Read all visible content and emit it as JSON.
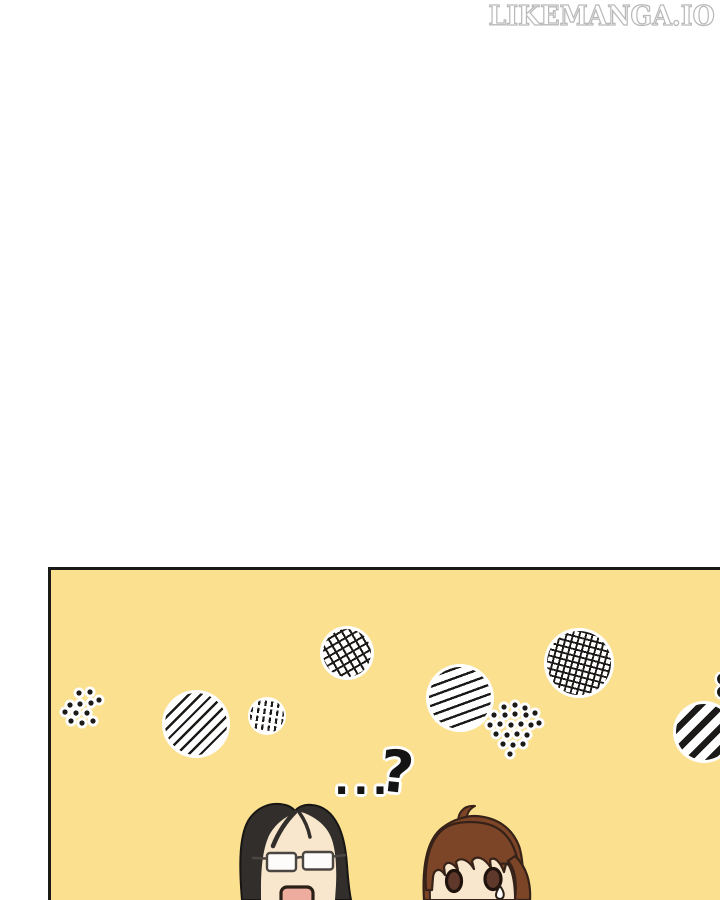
{
  "watermark": {
    "text": "LIKEMANGA.IO"
  },
  "speech": {
    "ellipsis": "...",
    "question": "?",
    "question_partial": "?"
  },
  "panel": {
    "decor": [
      "dot-cluster-small",
      "diagonal-hatch-circle",
      "dash-circle",
      "crosshatch-circle",
      "steep-hatch-circle",
      "dot-cluster-large",
      "grid-hatch-circle",
      "bold-stripe-circle"
    ]
  },
  "characters": [
    {
      "name": "long-black-hair-glasses-character"
    },
    {
      "name": "brown-hair-character"
    }
  ],
  "colors": {
    "panel_yellow": "#FBE08F",
    "ink": "#1C1A18",
    "pattern_bg": "#FFFFFF",
    "hair_black": "#312E2C",
    "hair_black_outline": "#181614",
    "hair_brown": "#7C4527",
    "hair_brown_outline": "#362218",
    "skin": "#F8E7CC",
    "mouth_pink": "#EEAC9F",
    "mouth_outline": "#2B2017",
    "eye_brown": "#5E382B",
    "eye_outline": "#20120D",
    "glasses_frame": "#4C4642",
    "lens_white": "#FDFCFA",
    "watermark_gray": "#B9B9B9",
    "page_bg": "#FFFFFF"
  }
}
